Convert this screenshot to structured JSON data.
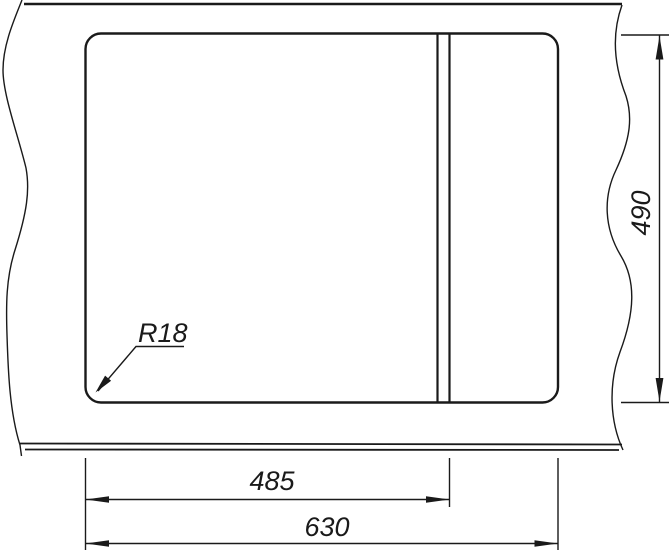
{
  "drawing": {
    "background_color": "#ffffff",
    "line_color": "#1a1a1a",
    "labels": {
      "overall_width": "630",
      "width_to_divider": "485",
      "depth": "490",
      "corner_radius": "R18"
    }
  }
}
